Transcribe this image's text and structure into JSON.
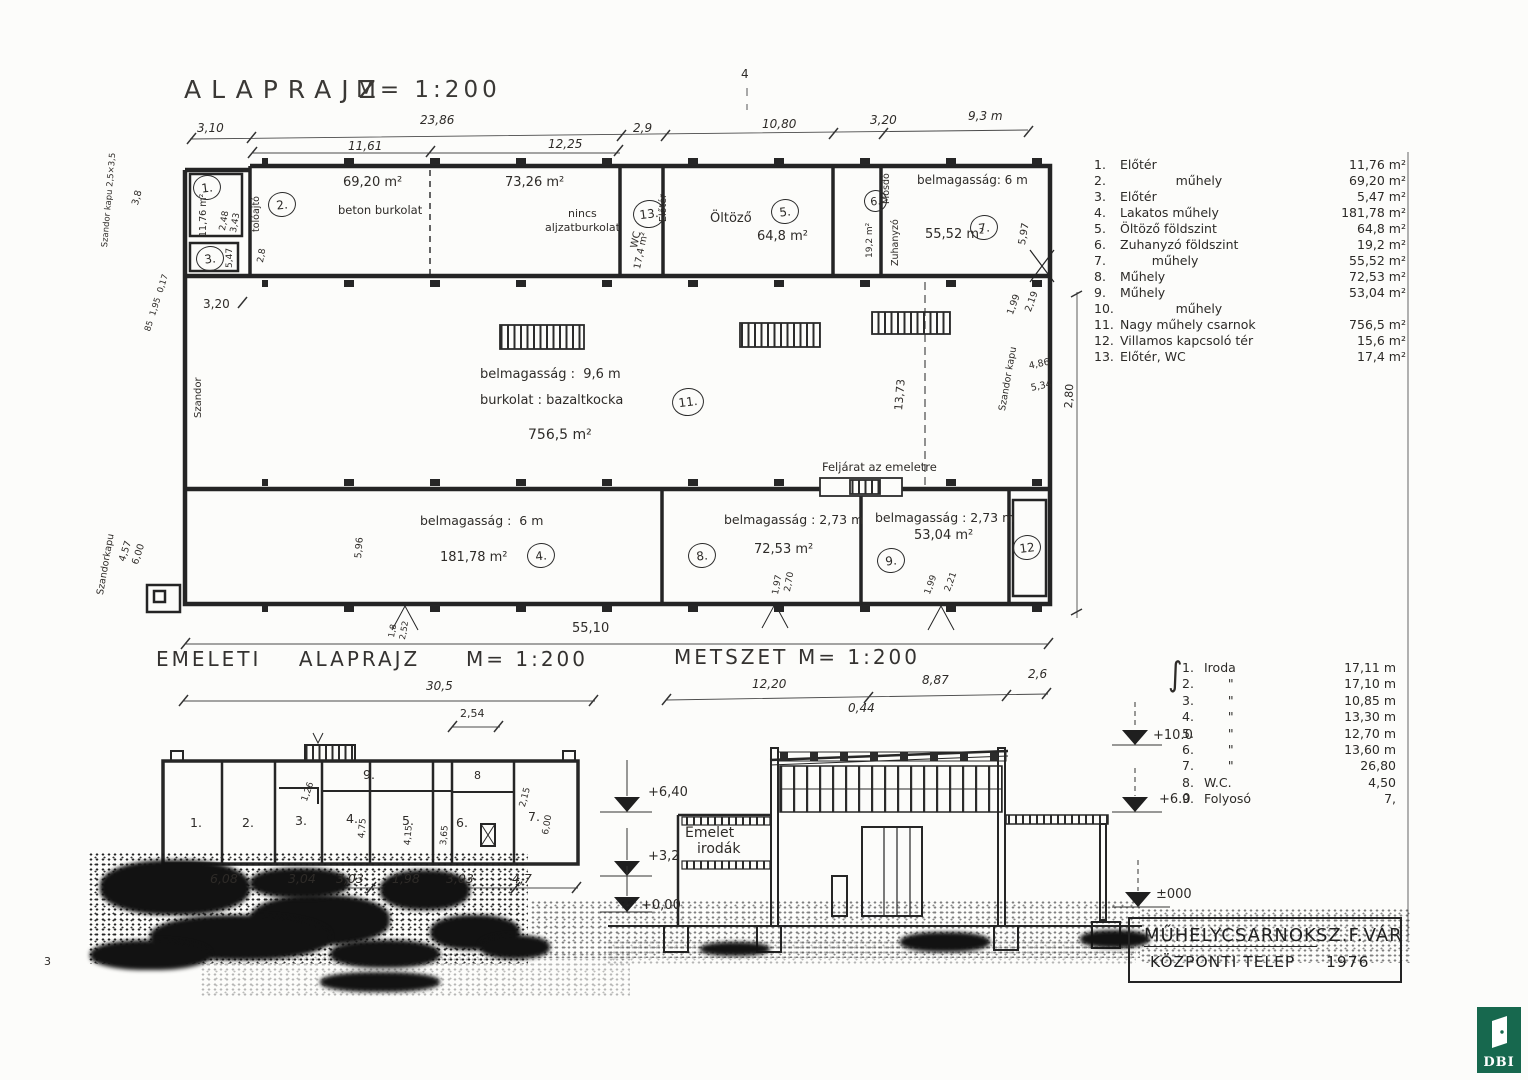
{
  "page": {
    "number": "3",
    "fold_mark": "4"
  },
  "titles": {
    "ground": "ALAPRAJZ",
    "ground_scale": "M= 1:200",
    "upper": "EMELETI    ALAPRAJZ",
    "upper_scale": "M= 1:200",
    "section": "METSZET",
    "section_scale": "M= 1:200"
  },
  "g": {
    "d": {
      "top1": "3,10",
      "top2": "23,86",
      "top2a": "11,61",
      "top2b": "12,25",
      "top3": "2,9",
      "top4": "10,80",
      "top5": "3,20",
      "top6": "9,3 m",
      "total": "55,10",
      "hall_h": "13,73",
      "right_h": "2,80",
      "r7h": "5,97",
      "d320": "3,20",
      "d38": "3,8",
      "notes": "85  1,95  0,17",
      "annex_note": "Szandor kapu 2,5×3,5",
      "szandor": "Szandor",
      "gate_bl": "Szandorkapu",
      "d457": "4,57",
      "d600": "6,00",
      "d596": "5,96",
      "gate_r": "Szandor kapu",
      "d486": "4,86",
      "d534": "5,34",
      "d199": "1,99",
      "d219": "2,19",
      "r1d1": "2,48",
      "r1d2": "3,43",
      "r2d": "2,8",
      "r3d": "5,47",
      "r8d1": "1,97",
      "r8d2": "2,70",
      "r9d1": "1,99",
      "r9d2": "2,21",
      "b1": "1,8",
      "b2": "2,52",
      "door2": "tolóajtó"
    },
    "r": {
      "n1": "1.",
      "a1": "11,76 m²",
      "n2": "2.",
      "a2a": "69,20 m²",
      "t2a": "beton burkolat",
      "a2b": "73,26 m²",
      "t2b1": "nincs",
      "t2b2": "aljzatburkolat",
      "n3": "3.",
      "n13": "13.",
      "wc": "WC",
      "a13": "17,4 m²",
      "v13": "Előtér",
      "n5": "5.",
      "name5": "Öltöző",
      "a5": "64,8 m²",
      "n6": "6.",
      "m6a": "Mosdó",
      "m6b": "Zuhanyzó",
      "a6": "19,2 m²",
      "n7": "7.",
      "t7": "belmagasság: 6 m",
      "a7": "55,52 m²",
      "n11": "11.",
      "t11a": "belmagasság :  9,6 m",
      "t11b": "burkolat : bazaltkocka",
      "a11": "756,5 m²",
      "stair": "Feljárat az emeletre",
      "n4": "4.",
      "t4": "belmagasság :  6 m",
      "a4": "181,78 m²",
      "n8": "8.",
      "t8": "belmagasság : 2,73 m",
      "a8": "72,53 m²",
      "n9": "9.",
      "t9": "belmagasság : 2,73 m",
      "a9": "53,04 m²",
      "n12": "12"
    }
  },
  "room_legend": {
    "items": [
      {
        "no": "1.",
        "name": "Előtér",
        "area": "11,76 m²"
      },
      {
        "no": "2.",
        "name": "              műhely",
        "area": "69,20 m²"
      },
      {
        "no": "3.",
        "name": "Előtér",
        "area": "5,47 m²"
      },
      {
        "no": "4.",
        "name": "Lakatos műhely",
        "area": "181,78 m²"
      },
      {
        "no": "5.",
        "name": "Öltöző földszint",
        "area": "64,8 m²"
      },
      {
        "no": "6.",
        "name": "Zuhanyzó földszint",
        "area": "19,2 m²"
      },
      {
        "no": "7.",
        "name": "        műhely",
        "area": "55,52 m²"
      },
      {
        "no": "8.",
        "name": "Műhely",
        "area": "72,53 m²"
      },
      {
        "no": "9.",
        "name": "Műhely",
        "area": "53,04 m²"
      },
      {
        "no": "10.",
        "name": "              műhely",
        "area": ""
      },
      {
        "no": "11.",
        "name": "Nagy műhely csarnok",
        "area": "756,5 m²"
      },
      {
        "no": "12.",
        "name": "Villamos kapcsoló tér",
        "area": "15,6 m²"
      },
      {
        "no": "13.",
        "name": "Előtér, WC",
        "area": "17,4 m²"
      }
    ]
  },
  "upper": {
    "total": "30,5",
    "top": "2,54",
    "b": [
      "6,08",
      "3,04",
      "3,03",
      "1,98",
      "3,03",
      "4,7"
    ],
    "rooms": [
      "1.",
      "2.",
      "3.",
      "4.",
      "5.",
      "6.",
      "7."
    ],
    "r8": "8",
    "r9": "9.",
    "i": [
      "1,26",
      "4,75",
      "4,15",
      "3,65",
      "2,15",
      "6,00"
    ]
  },
  "section": {
    "c1": "12,20",
    "c2": "8,87",
    "c3": "2,6",
    "c4": "0,44",
    "L": [
      "+6,40",
      "+3,2",
      "+0,00"
    ],
    "R": [
      "+10.0",
      "+6.0",
      "±000"
    ],
    "e1": "Emelet",
    "e2": "irodák"
  },
  "office_legend": {
    "brace": "∫",
    "items": [
      {
        "no": "1.",
        "name": "Iroda",
        "val": "17,11 m"
      },
      {
        "no": "2.",
        "name": "      \"",
        "val": "17,10 m"
      },
      {
        "no": "3.",
        "name": "      \"",
        "val": "10,85 m"
      },
      {
        "no": "4.",
        "name": "      \"",
        "val": "13,30 m"
      },
      {
        "no": "5.",
        "name": "      \"",
        "val": "12,70 m"
      },
      {
        "no": "6.",
        "name": "      \"",
        "val": "13,60 m"
      },
      {
        "no": "7.",
        "name": "      \"",
        "val": "26,80"
      },
      {
        "no": "8.",
        "name": "W.C.",
        "val": "4,50"
      },
      {
        "no": "9.",
        "name": "Folyosó",
        "val": "7,"
      }
    ]
  },
  "title_block": {
    "l1a": "MŰHELYCSARNOK",
    "l1b": "SZ.F.VÁR",
    "l2a": "KÖZPONTI TELEP",
    "l2b": "1976"
  },
  "logo": {
    "text": "DBI",
    "green": "#17684e"
  }
}
